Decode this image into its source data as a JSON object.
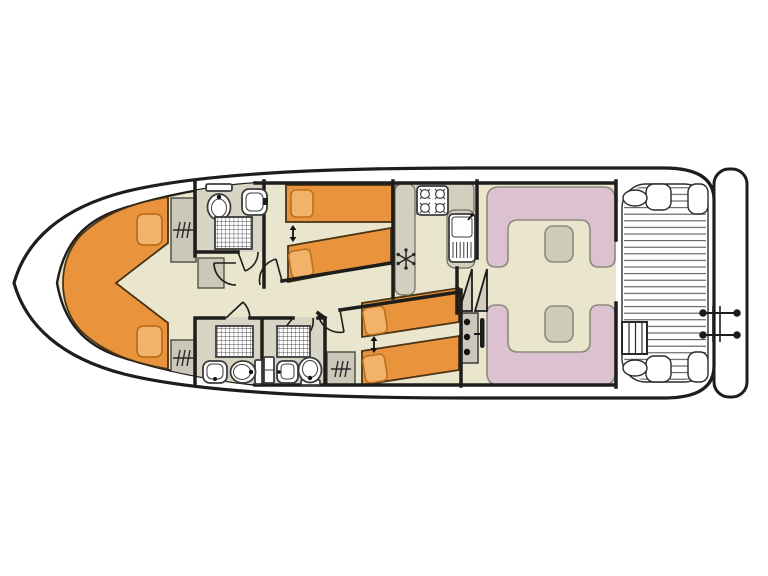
{
  "title": "houseboat-deck-floor-plan",
  "colors": {
    "wall": "#1d1d1b",
    "hull": "#1d1d1b",
    "floor": "#eae6ce",
    "bath": "#d9d5c4",
    "counter": "#d2cfc0",
    "unit": "#cbc8ba",
    "bed": "#e9943d",
    "bed_border": "#4a3414",
    "pillow": "#f2b269",
    "pillow_border": "#b9701f",
    "sofa": "#dcc2d1",
    "sofa_border": "#8b8b7d",
    "table": "#cfcbb5",
    "fixture": "#3c3c3c",
    "slat": "#4a4a4a",
    "white": "#ffffff"
  },
  "features": {
    "cabins": [
      {
        "name": "bow-v-berth-cabin",
        "beds": "v-shaped-double",
        "pillows": 2
      },
      {
        "name": "forward-twin-cabin",
        "beds": 2,
        "pillows": 2,
        "sliding_beds_arrow": true
      },
      {
        "name": "aft-twin-cabin",
        "beds": 2,
        "pillows": 2,
        "sliding_beds_arrow": true
      }
    ],
    "bathrooms": [
      {
        "name": "forward-bathroom",
        "fixtures": [
          "toilet",
          "sink",
          "shower"
        ]
      },
      {
        "name": "mid-port-bathroom",
        "fixtures": [
          "toilet",
          "sink",
          "shower"
        ]
      },
      {
        "name": "mid-starboard-bathroom",
        "fixtures": [
          "toilet",
          "sink",
          "shower"
        ]
      }
    ],
    "wardrobes": 3,
    "galley": {
      "stove_burners": 4,
      "sink": 1,
      "fridge_snowflake": true
    },
    "saloon": {
      "dinettes": 2,
      "tables": 2,
      "u_shaped_sofas": true
    },
    "helm": {
      "console_dots": 3,
      "steering_wheel": true,
      "companionway_steps": 2
    },
    "aft_deck": {
      "slatted_floor": true,
      "corner_benches": 4,
      "steps": 1,
      "ladder": true
    },
    "swim_platform": true
  }
}
